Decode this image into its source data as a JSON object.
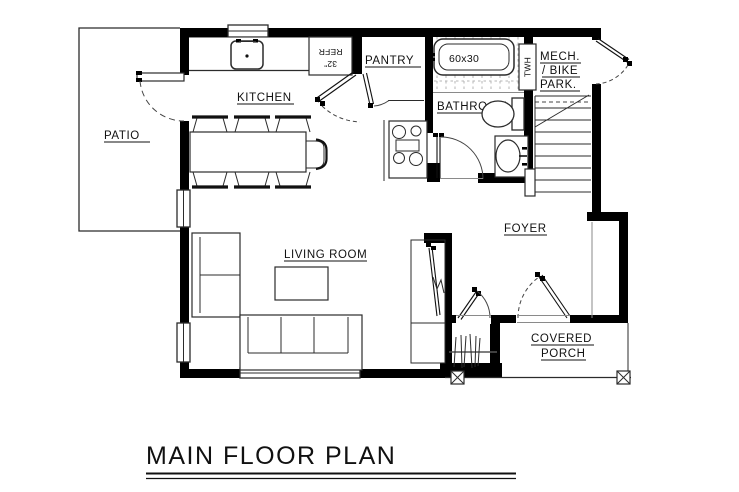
{
  "drawing": {
    "title": "MAIN FLOOR PLAN",
    "room_labels": {
      "patio": "PATIO",
      "kitchen": "KITCHEN",
      "pantry": "PANTRY",
      "bathroom": "BATHROOM",
      "foyer": "FOYER",
      "living_room": "LIVING ROOM",
      "covered_porch_line1": "COVERED",
      "covered_porch_line2": "PORCH",
      "mech_bike_line1": "MECH.",
      "mech_bike_line2": "/ BIKE",
      "mech_bike_line3": "PARK."
    },
    "annotations": {
      "tub_size": "60x30",
      "tankless_water_heater": "TWH",
      "refrigerator_line1": "REFR",
      "refrigerator_line2": "32\""
    },
    "colors": {
      "walls": "#000000",
      "lines": "#2b2b2b",
      "light_lines": "#8a8a8a",
      "tile_lines": "#b5b5b5",
      "background": "#ffffff"
    }
  }
}
